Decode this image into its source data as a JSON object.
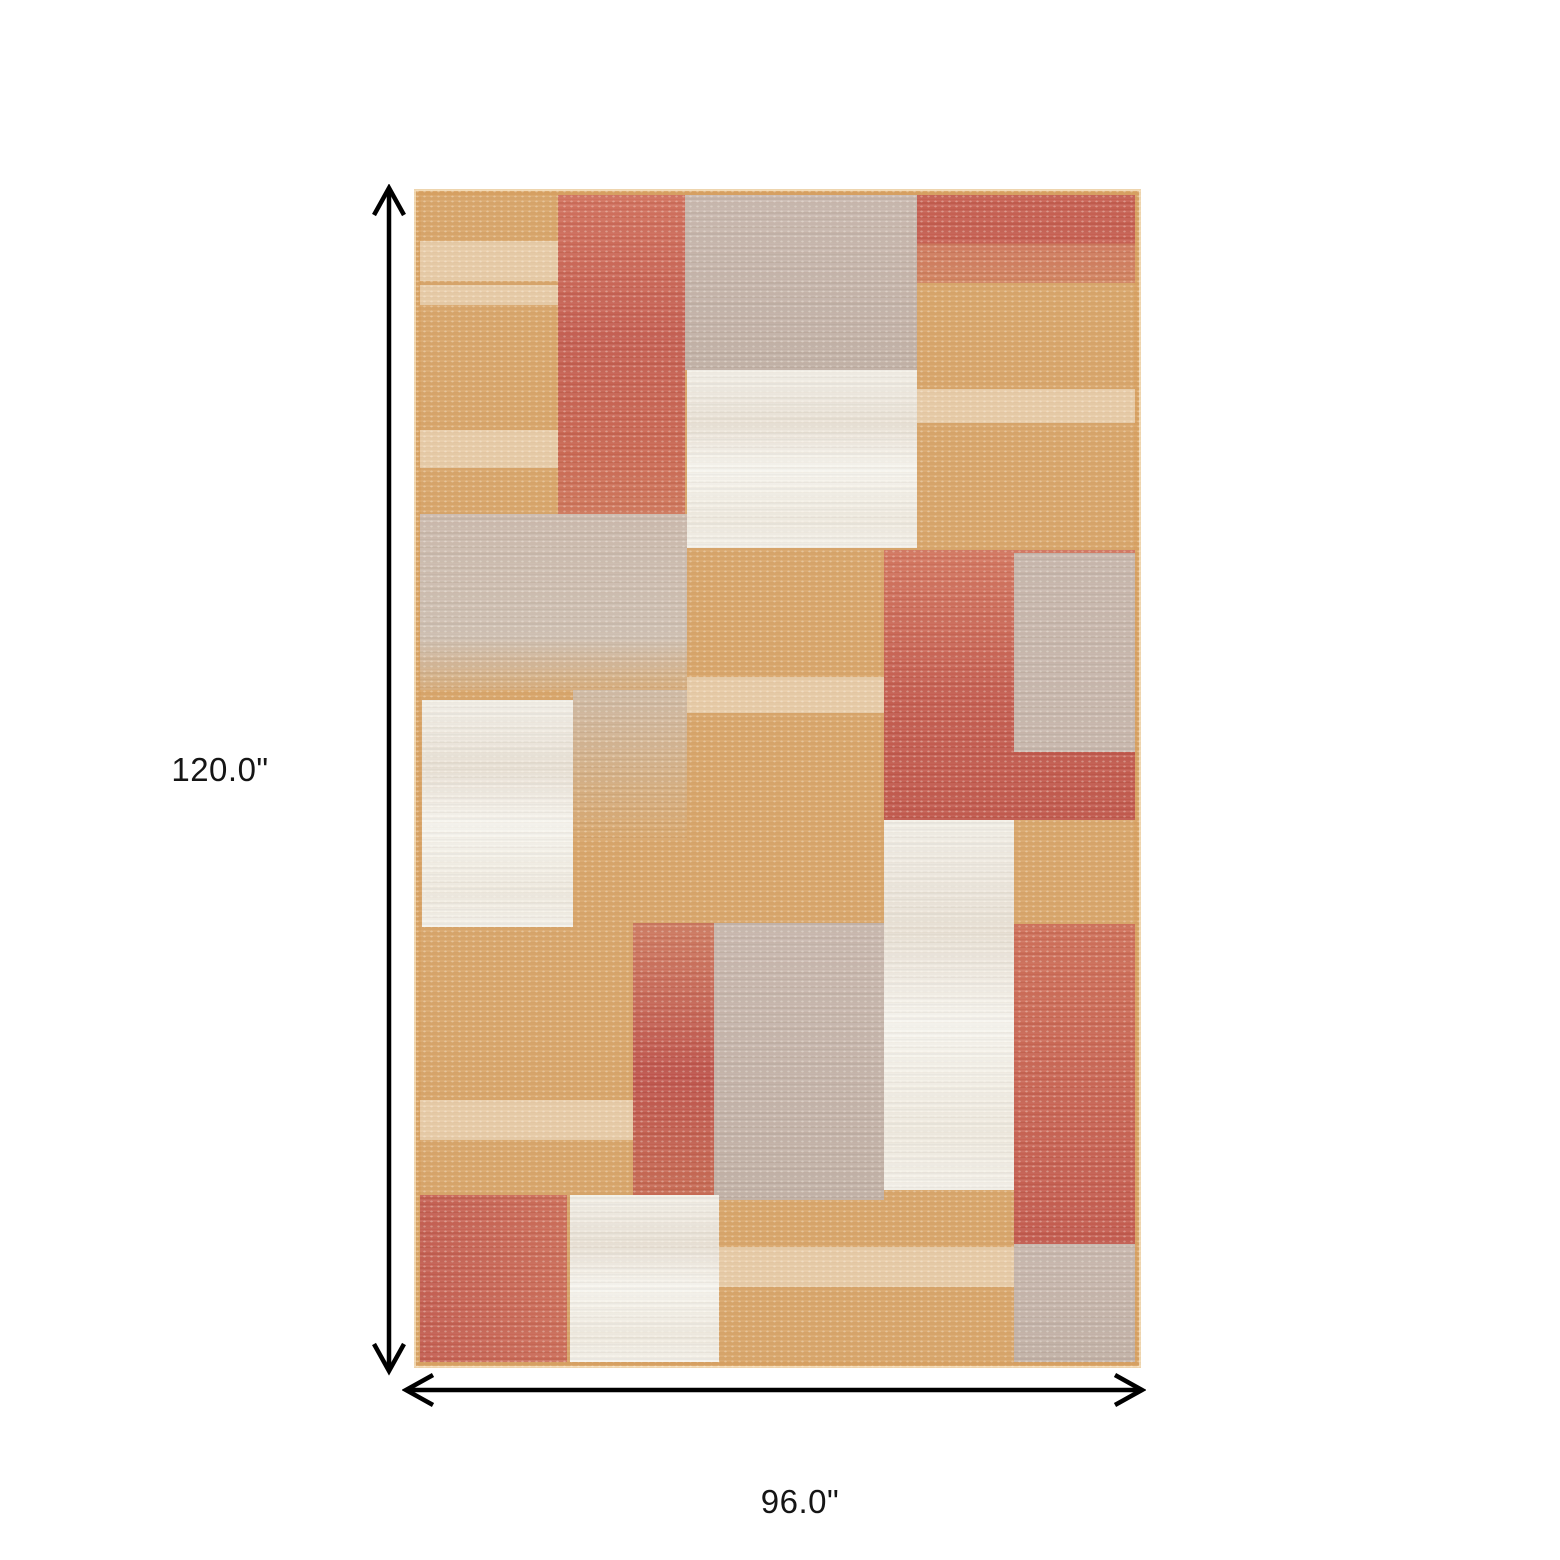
{
  "annotations": {
    "height_label": "120.0\"",
    "width_label": "96.0\""
  },
  "arrow_color": "#000000",
  "palette": {
    "tan": "#d9a76c",
    "coral_top_col": "linear-gradient(180deg,#d2705c 0%,#c65e51 45%,#cb6752 80%,#d0775b 100%)",
    "coral_top_right": "linear-gradient(180deg,#c75e50 0%,#c75e50 55%,#d0795d 55%,#d2835f 100%)",
    "coral_mid_right": "linear-gradient(180deg,#d4765f 0%,#c55c4f 55%,#c2584c 100%)",
    "coral_mid_col": "linear-gradient(180deg,#cf7a60 0%,#c0544c 55%,#c86b53 100%)",
    "coral_bottom_right": "linear-gradient(180deg,#cf6f58 0%,#c45a4e 100%)",
    "coral_bottom_left": "linear-gradient(90deg,#c55e51 0%,#cd6d58 100%)",
    "taupe": "linear-gradient(180deg,#c9b8ae 0%,#c2b1a6 100%)",
    "taupe_flat": "#c8b7ac",
    "white": "linear-gradient(180deg,#f2efe7 0%,#e9e1d5 30%,#f7f5ef 55%,#efeadf 85%,#f4f1ea 100%)",
    "beige": "linear-gradient(180deg,#ccbaad 0%,#cfc0b2 70%,rgba(207,192,178,0.2) 100%)",
    "beige_fade": "linear-gradient(180deg,rgba(206,190,175,0.85) 0%,rgba(206,190,175,0) 100%)",
    "streak": "rgba(242,229,209,0.6)"
  },
  "rug": {
    "patches": [
      {
        "name": "rug-patch-beige-left-mid",
        "fill": "beige",
        "x": 6,
        "y": 325,
        "w": 267,
        "h": 176
      },
      {
        "name": "rug-patch-beige-left-fade",
        "fill": "beige_fade",
        "x": 159,
        "y": 501,
        "w": 114,
        "h": 150
      },
      {
        "name": "rug-streak-top-left-1",
        "fill": "streak",
        "streak": true,
        "x": 6,
        "y": 52,
        "w": 139,
        "h": 40
      },
      {
        "name": "rug-streak-top-left-2",
        "fill": "streak",
        "streak": true,
        "x": 6,
        "y": 96,
        "w": 139,
        "h": 20
      },
      {
        "name": "rug-streak-top-left-3",
        "fill": "streak",
        "streak": true,
        "x": 6,
        "y": 241,
        "w": 139,
        "h": 38
      },
      {
        "name": "rug-streak-top-right",
        "fill": "streak",
        "streak": true,
        "x": 503,
        "y": 200,
        "w": 218,
        "h": 34
      },
      {
        "name": "rug-streak-center",
        "fill": "streak",
        "streak": true,
        "x": 273,
        "y": 488,
        "w": 197,
        "h": 36
      },
      {
        "name": "rug-streak-bottom-left",
        "fill": "streak",
        "streak": true,
        "x": 6,
        "y": 911,
        "w": 213,
        "h": 40
      },
      {
        "name": "rug-streak-bottom-center",
        "fill": "streak",
        "streak": true,
        "x": 305,
        "y": 1058,
        "w": 295,
        "h": 40
      },
      {
        "name": "rug-patch-coral-top-column",
        "fill": "coral_top_col",
        "x": 144,
        "y": 6,
        "w": 127,
        "h": 319
      },
      {
        "name": "rug-patch-taupe-top-middle",
        "fill": "taupe",
        "x": 271,
        "y": 6,
        "w": 232,
        "h": 175
      },
      {
        "name": "rug-patch-white-top-middle",
        "fill": "white",
        "x": 273,
        "y": 181,
        "w": 230,
        "h": 178
      },
      {
        "name": "rug-patch-coral-top-right",
        "fill": "coral_top_right",
        "x": 503,
        "y": 6,
        "w": 218,
        "h": 88
      },
      {
        "name": "rug-patch-coral-mid-right",
        "fill": "coral_mid_right",
        "x": 470,
        "y": 361,
        "w": 251,
        "h": 270
      },
      {
        "name": "rug-patch-taupe-mid-right",
        "fill": "taupe_flat",
        "x": 600,
        "y": 364,
        "w": 121,
        "h": 199
      },
      {
        "name": "rug-patch-white-right-column",
        "fill": "white",
        "x": 470,
        "y": 631,
        "w": 130,
        "h": 370
      },
      {
        "name": "rug-patch-coral-mid-column",
        "fill": "coral_mid_col",
        "x": 219,
        "y": 734,
        "w": 81,
        "h": 277
      },
      {
        "name": "rug-patch-taupe-mid-block",
        "fill": "taupe",
        "x": 300,
        "y": 734,
        "w": 170,
        "h": 277
      },
      {
        "name": "rug-patch-coral-bottom-right",
        "fill": "coral_bottom_right",
        "x": 600,
        "y": 735,
        "w": 121,
        "h": 320
      },
      {
        "name": "rug-patch-taupe-bottom-right",
        "fill": "taupe",
        "x": 600,
        "y": 1055,
        "w": 121,
        "h": 118
      },
      {
        "name": "rug-patch-white-left",
        "fill": "white",
        "x": 8,
        "y": 511,
        "w": 151,
        "h": 227
      },
      {
        "name": "rug-patch-coral-bottom-left",
        "fill": "coral_bottom_left",
        "x": 6,
        "y": 1006,
        "w": 147,
        "h": 167
      },
      {
        "name": "rug-patch-white-bottom",
        "fill": "white",
        "x": 156,
        "y": 1006,
        "w": 149,
        "h": 167
      }
    ]
  }
}
